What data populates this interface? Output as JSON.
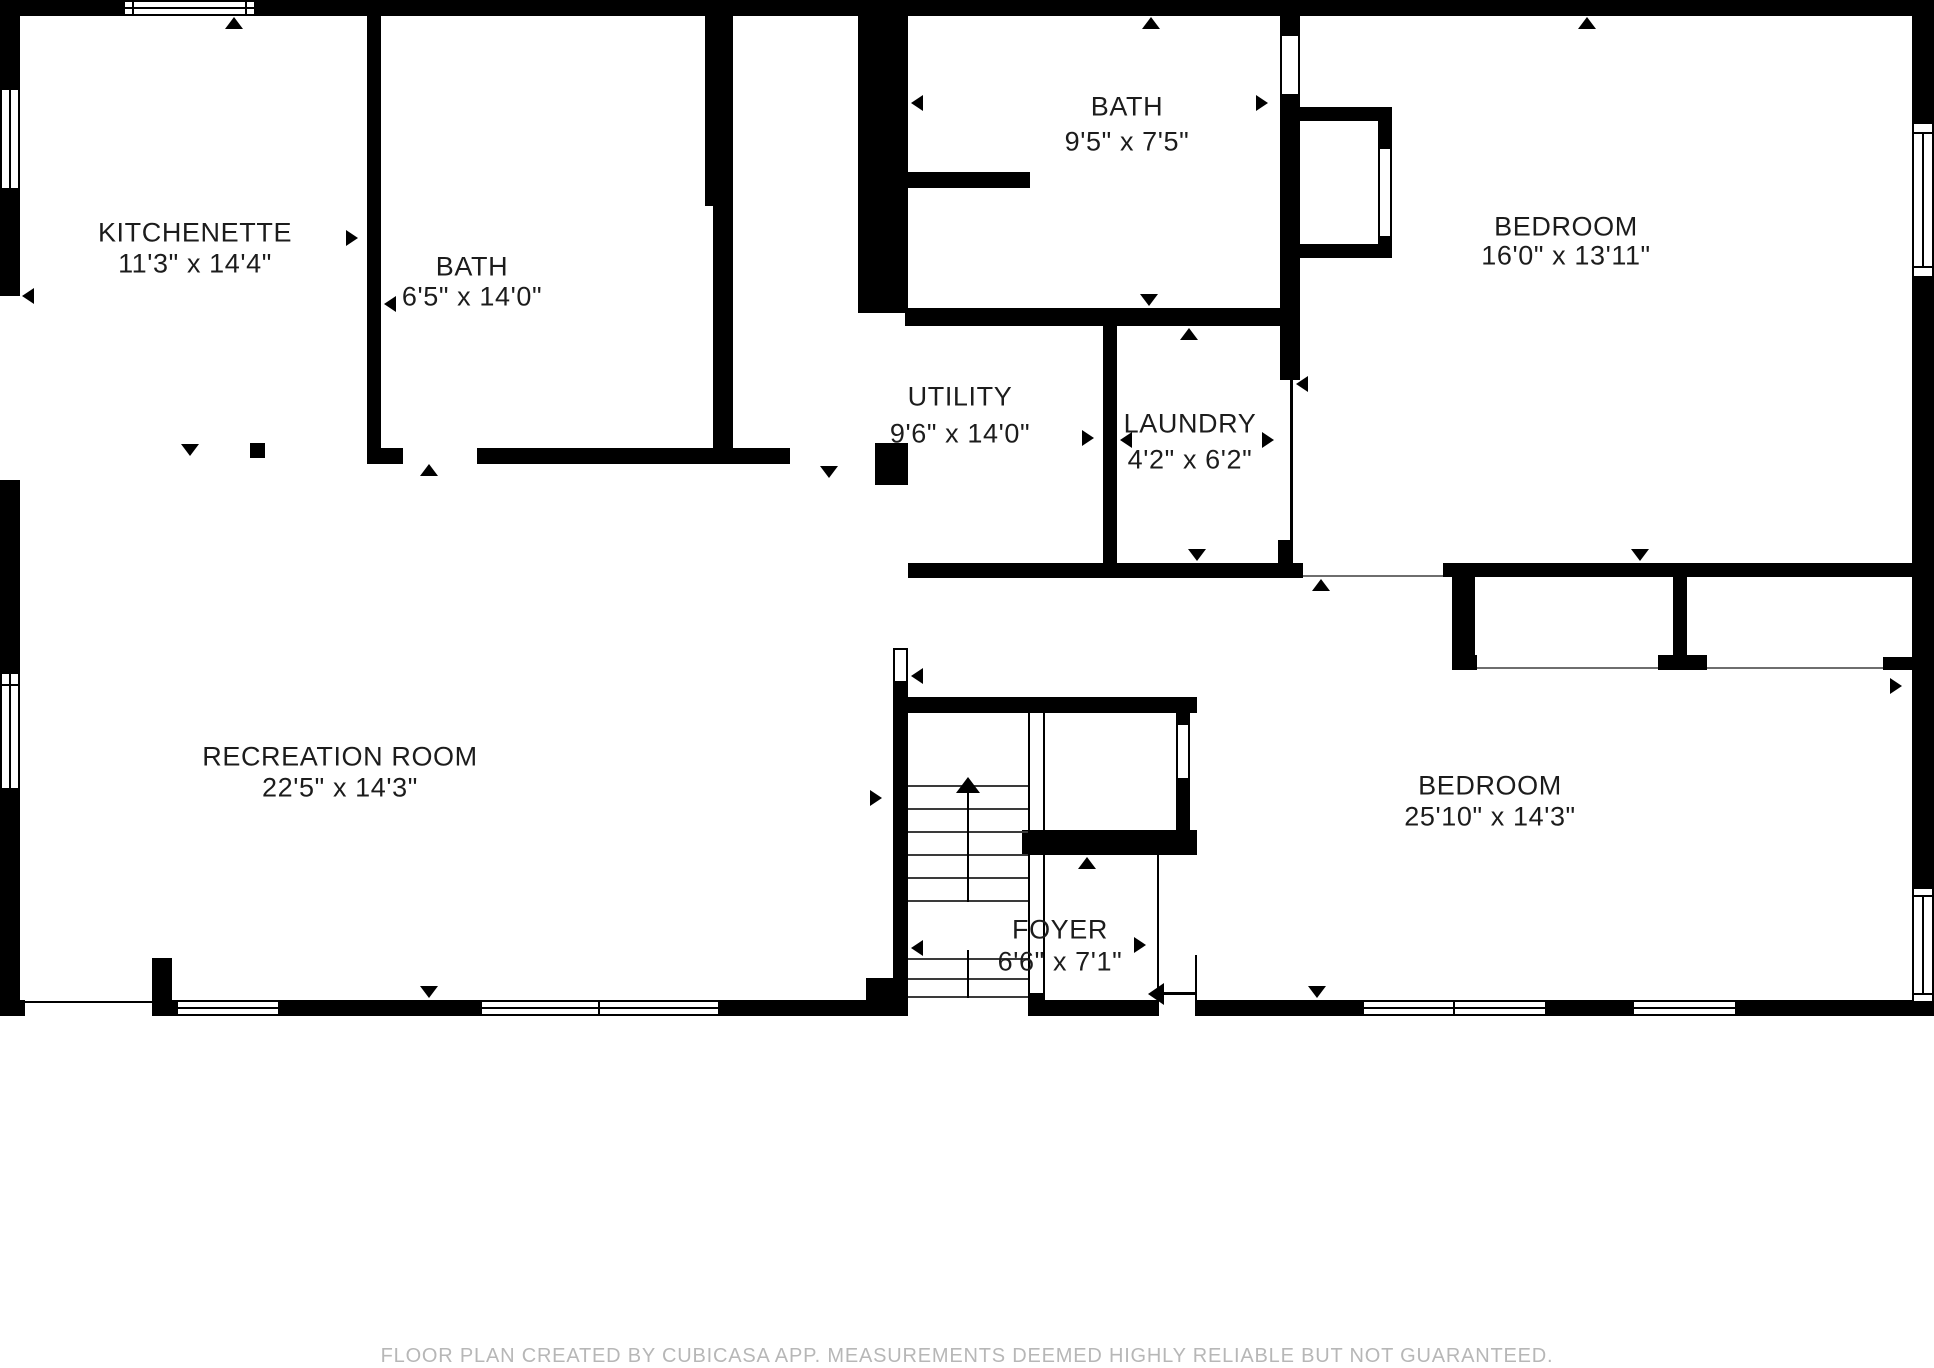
{
  "rooms": [
    {
      "name": "KITCHENETTE",
      "dims": "11'3\" x 14'4\""
    },
    {
      "name": "BATH",
      "dims": "6'5\" x 14'0\""
    },
    {
      "name": "BATH",
      "dims": "9'5\" x 7'5\""
    },
    {
      "name": "UTILITY",
      "dims": "9'6\" x 14'0\""
    },
    {
      "name": "LAUNDRY",
      "dims": "4'2\" x 6'2\""
    },
    {
      "name": "BEDROOM",
      "dims": "16'0\" x 13'11\""
    },
    {
      "name": "RECREATION ROOM",
      "dims": "22'5\" x 14'3\""
    },
    {
      "name": "FOYER",
      "dims": "6'6\" x 7'1\""
    },
    {
      "name": "BEDROOM",
      "dims": "25'10\" x 14'3\""
    }
  ],
  "footer": {
    "text": "FLOOR PLAN CREATED BY CUBICASA APP. MEASUREMENTS DEEMED HIGHLY RELIABLE BUT NOT GUARANTEED."
  },
  "colors": {
    "wall": "#000000",
    "background": "#ffffff",
    "footer_text": "#b7b7b7",
    "label_text": "#1c1c1c"
  }
}
